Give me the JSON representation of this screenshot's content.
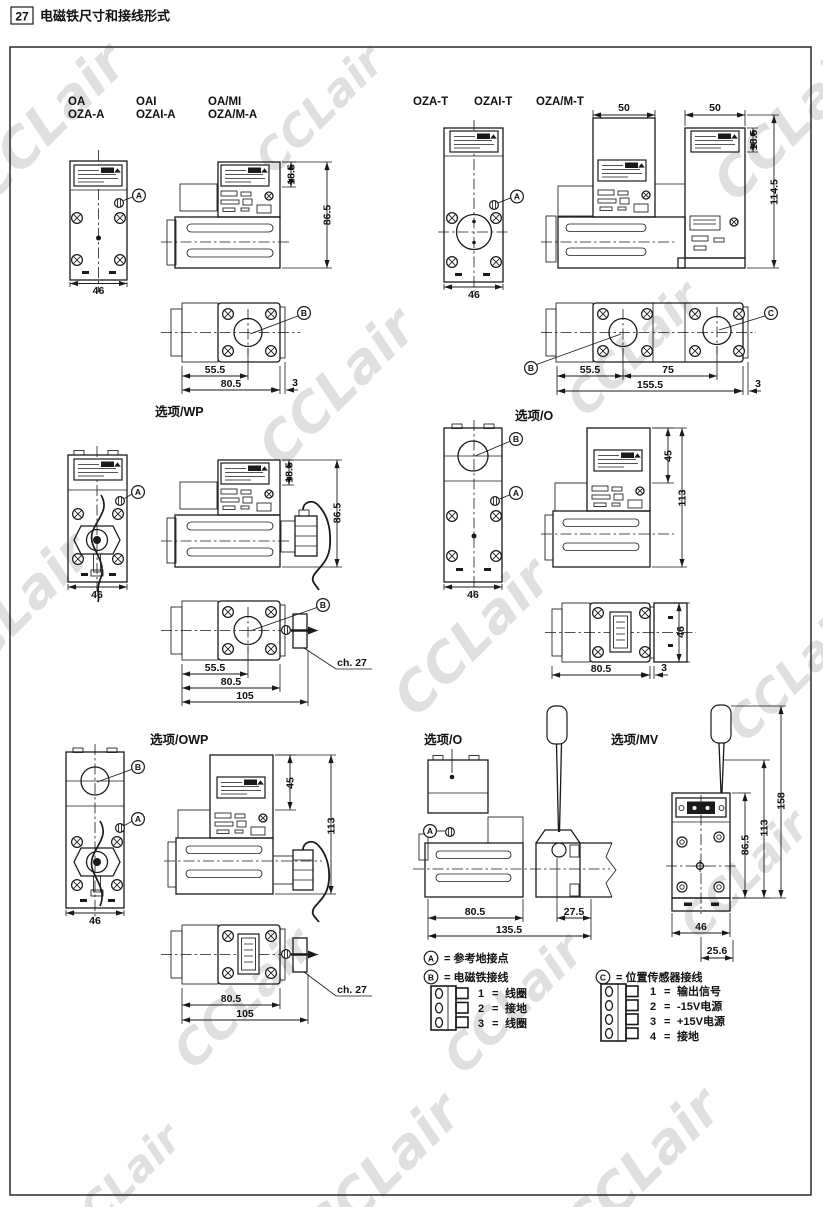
{
  "page": {
    "number": "27",
    "title": "电磁铁尺寸和接线形式",
    "watermark": "CCLair"
  },
  "colors": {
    "line": "#1a1a1a",
    "watermark": "#dadada"
  },
  "models": {
    "left": [
      {
        "l1": "OA",
        "l2": "OZA-A"
      },
      {
        "l1": "OAI",
        "l2": "OZAI-A"
      },
      {
        "l1": "OA/MI",
        "l2": "OZA/M-A"
      }
    ],
    "right": [
      {
        "l1": "OZA-T"
      },
      {
        "l1": "OZAI-T"
      },
      {
        "l1": "OZA/M-T"
      }
    ]
  },
  "captions": {
    "wp": "选项/WP",
    "o_top": "选项/O",
    "owp": "选项/OWP",
    "o_bottom": "选项/O",
    "mv": "选项/MV"
  },
  "callouts": {
    "a": "A",
    "b": "B",
    "c": "C"
  },
  "dims": {
    "d46": "46",
    "d50": "50",
    "d18_5": "18.5",
    "d86_5": "86.5",
    "d114_5": "114.5",
    "d55_5": "55.5",
    "d75": "75",
    "d80_5": "80.5",
    "d155_5": "155.5",
    "d3": "3",
    "d45": "45",
    "d113": "113",
    "d105": "105",
    "d135_5": "135.5",
    "d27_5": "27.5",
    "d158": "158",
    "d25_6": "25.6",
    "ch27": "ch. 27"
  },
  "legend": {
    "a_sym": "A",
    "a_text": "= 参考地接点",
    "b_sym": "B",
    "b_text": "= 电磁铁接线",
    "c_sym": "C",
    "c_text": "= 位置传感器接线",
    "b_items": [
      {
        "n": "1",
        "eq": "=",
        "t": "线圈"
      },
      {
        "n": "2",
        "eq": "=",
        "t": "接地"
      },
      {
        "n": "3",
        "eq": "=",
        "t": "线圈"
      }
    ],
    "c_items": [
      {
        "n": "1",
        "eq": "=",
        "t": "输出信号"
      },
      {
        "n": "2",
        "eq": "=",
        "t": "-15V电源"
      },
      {
        "n": "3",
        "eq": "=",
        "t": "+15V电源"
      },
      {
        "n": "4",
        "eq": "=",
        "t": "接地"
      }
    ]
  }
}
